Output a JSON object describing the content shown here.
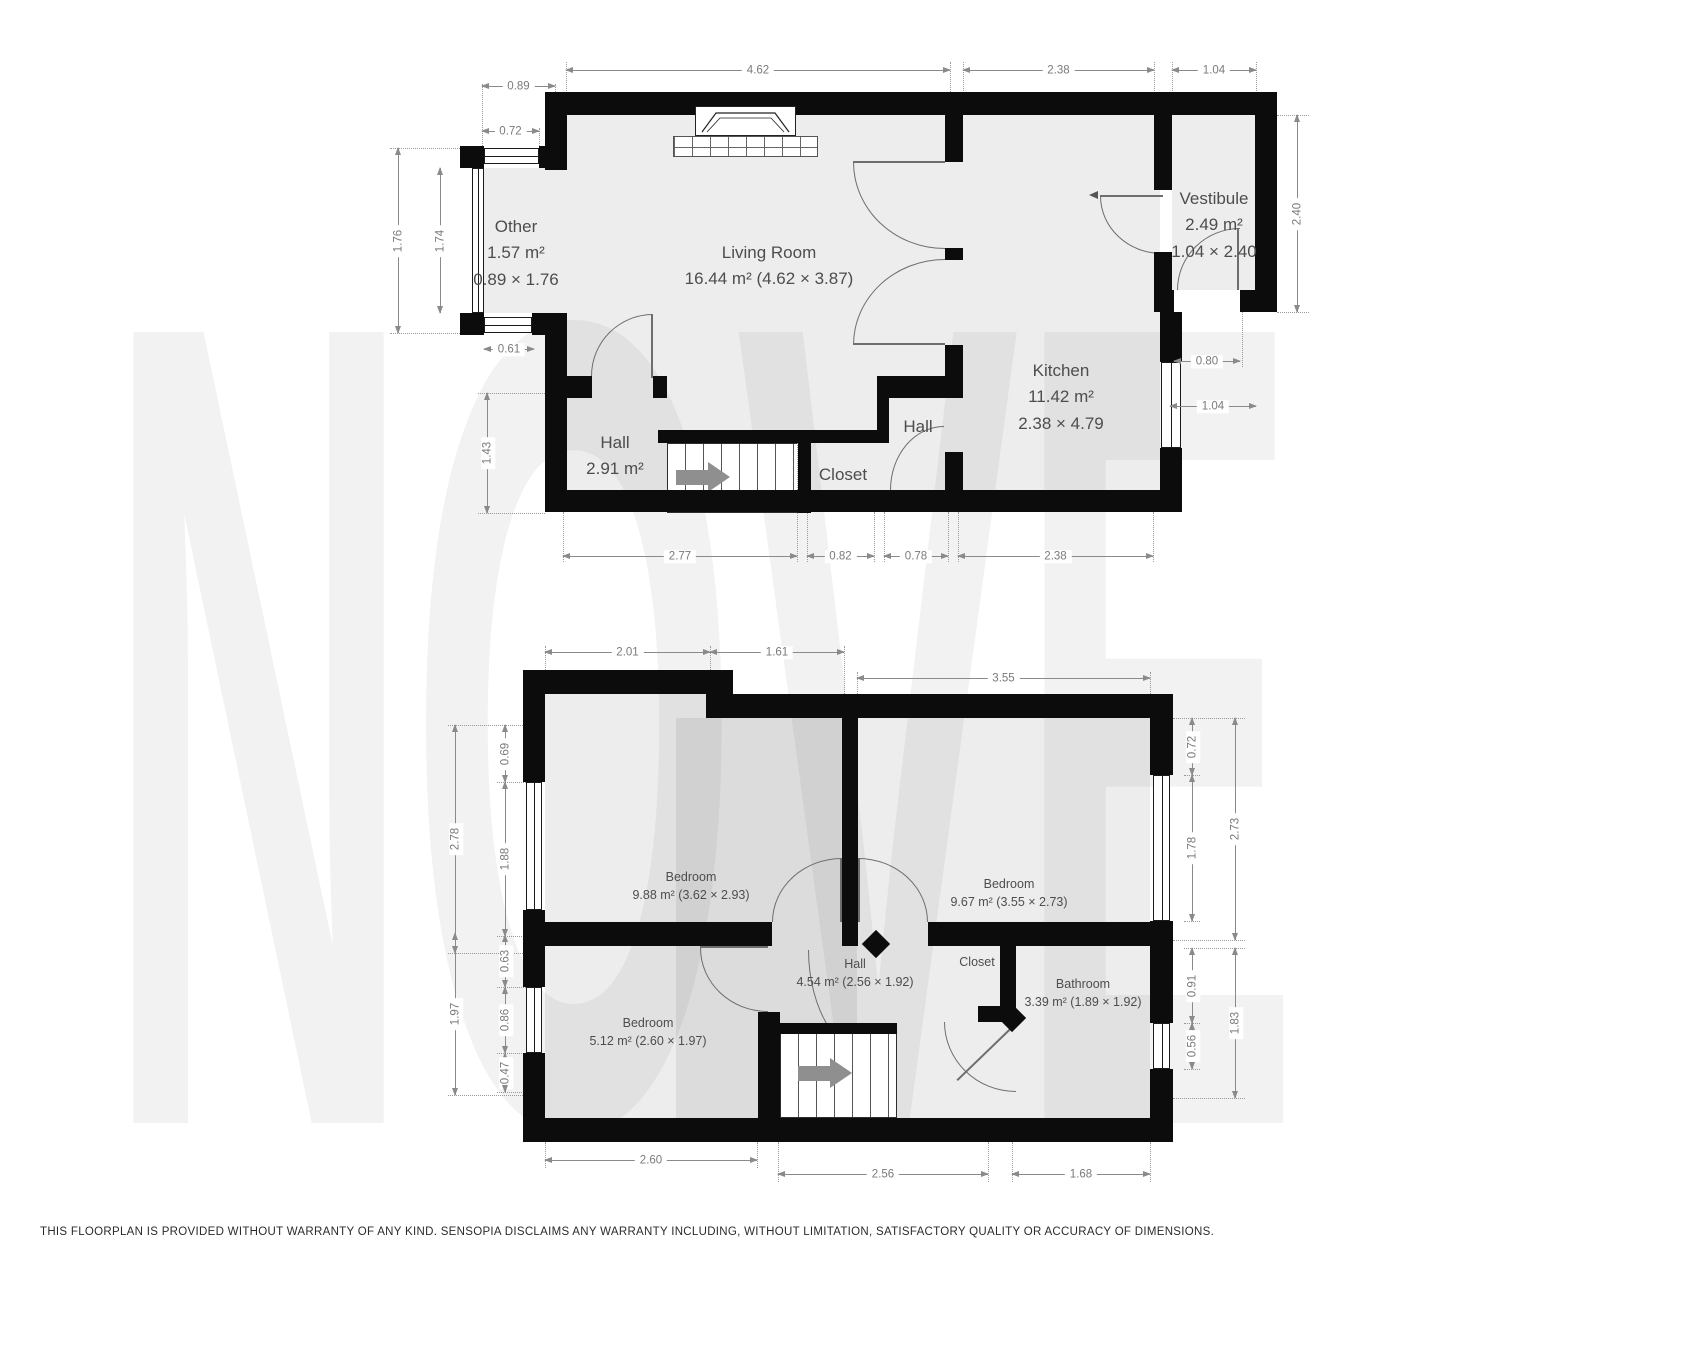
{
  "watermark": "NOVE",
  "disclaimer": "THIS FLOORPLAN IS PROVIDED WITHOUT WARRANTY OF ANY KIND. SENSOPIA DISCLAIMS ANY WARRANTY INCLUDING, WITHOUT LIMITATION, SATISFACTORY QUALITY OR ACCURACY OF DIMENSIONS.",
  "colors": {
    "wall": "#0c0c0c",
    "floor_fill": "#ececec",
    "dimension_line": "#8a8a8a",
    "room_label": "#4d4d4d",
    "door_arc": "#6e6e6e",
    "watermark": "#f2f2f2"
  },
  "floor1": {
    "rooms": {
      "other": {
        "name": "Other",
        "area": "1.57 m²",
        "size": "0.89 × 1.76"
      },
      "living": {
        "name": "Living Room",
        "area": "16.44 m² (4.62 × 3.87)"
      },
      "vestibule": {
        "name": "Vestibule",
        "area": "2.49 m²",
        "size": "1.04 × 2.40"
      },
      "kitchen": {
        "name": "Kitchen",
        "area": "11.42 m²",
        "size": "2.38 × 4.79"
      },
      "hall": {
        "name": "Hall",
        "area": "2.91 m²"
      },
      "hall2": {
        "name": "Hall"
      },
      "closet": {
        "name": "Closet"
      }
    },
    "dims": {
      "bay_width": "0.89",
      "bay_window_top": "0.72",
      "living_width": "4.62",
      "kitchen_width_top": "2.38",
      "vestibule_width": "1.04",
      "bay_height_outer": "1.76",
      "bay_height_inner": "1.74",
      "hall_height": "1.43",
      "bay_window_bottom": "0.61",
      "vestibule_height": "2.40",
      "vestibule_door": "0.80",
      "kitchen_window": "1.04",
      "bottom_hall": "2.77",
      "bottom_closet": "0.82",
      "bottom_hall2": "0.78",
      "bottom_kitchen": "2.38"
    }
  },
  "floor2": {
    "rooms": {
      "bedroom_left": {
        "name": "Bedroom",
        "area": "9.88 m² (3.62 × 2.93)"
      },
      "bedroom_right": {
        "name": "Bedroom",
        "area": "9.67 m² (3.55 × 2.73)"
      },
      "bedroom_small": {
        "name": "Bedroom",
        "area": "5.12 m² (2.60 × 1.97)"
      },
      "hall": {
        "name": "Hall",
        "area": "4.54 m² (2.56 × 1.92)"
      },
      "closet": {
        "name": "Closet"
      },
      "bathroom": {
        "name": "Bathroom",
        "area": "3.39 m² (1.89 × 1.92)"
      }
    },
    "dims": {
      "top_left": "2.01",
      "top_mid": "1.61",
      "top_right": "3.55",
      "left_outer_top": "2.78",
      "left_seg_top": "0.69",
      "left_window_top": "1.88",
      "left_outer_bottom": "1.97",
      "left_seg1": "0.63",
      "left_seg2": "0.86",
      "left_seg3": "0.47",
      "right_seg_top": "0.72",
      "right_window_top": "1.78",
      "right_outer_top": "2.73",
      "right_seg1": "0.91",
      "right_seg2": "0.56",
      "right_outer_bottom": "1.83",
      "bottom_left": "2.60",
      "bottom_mid": "2.56",
      "bottom_right": "1.68"
    }
  }
}
